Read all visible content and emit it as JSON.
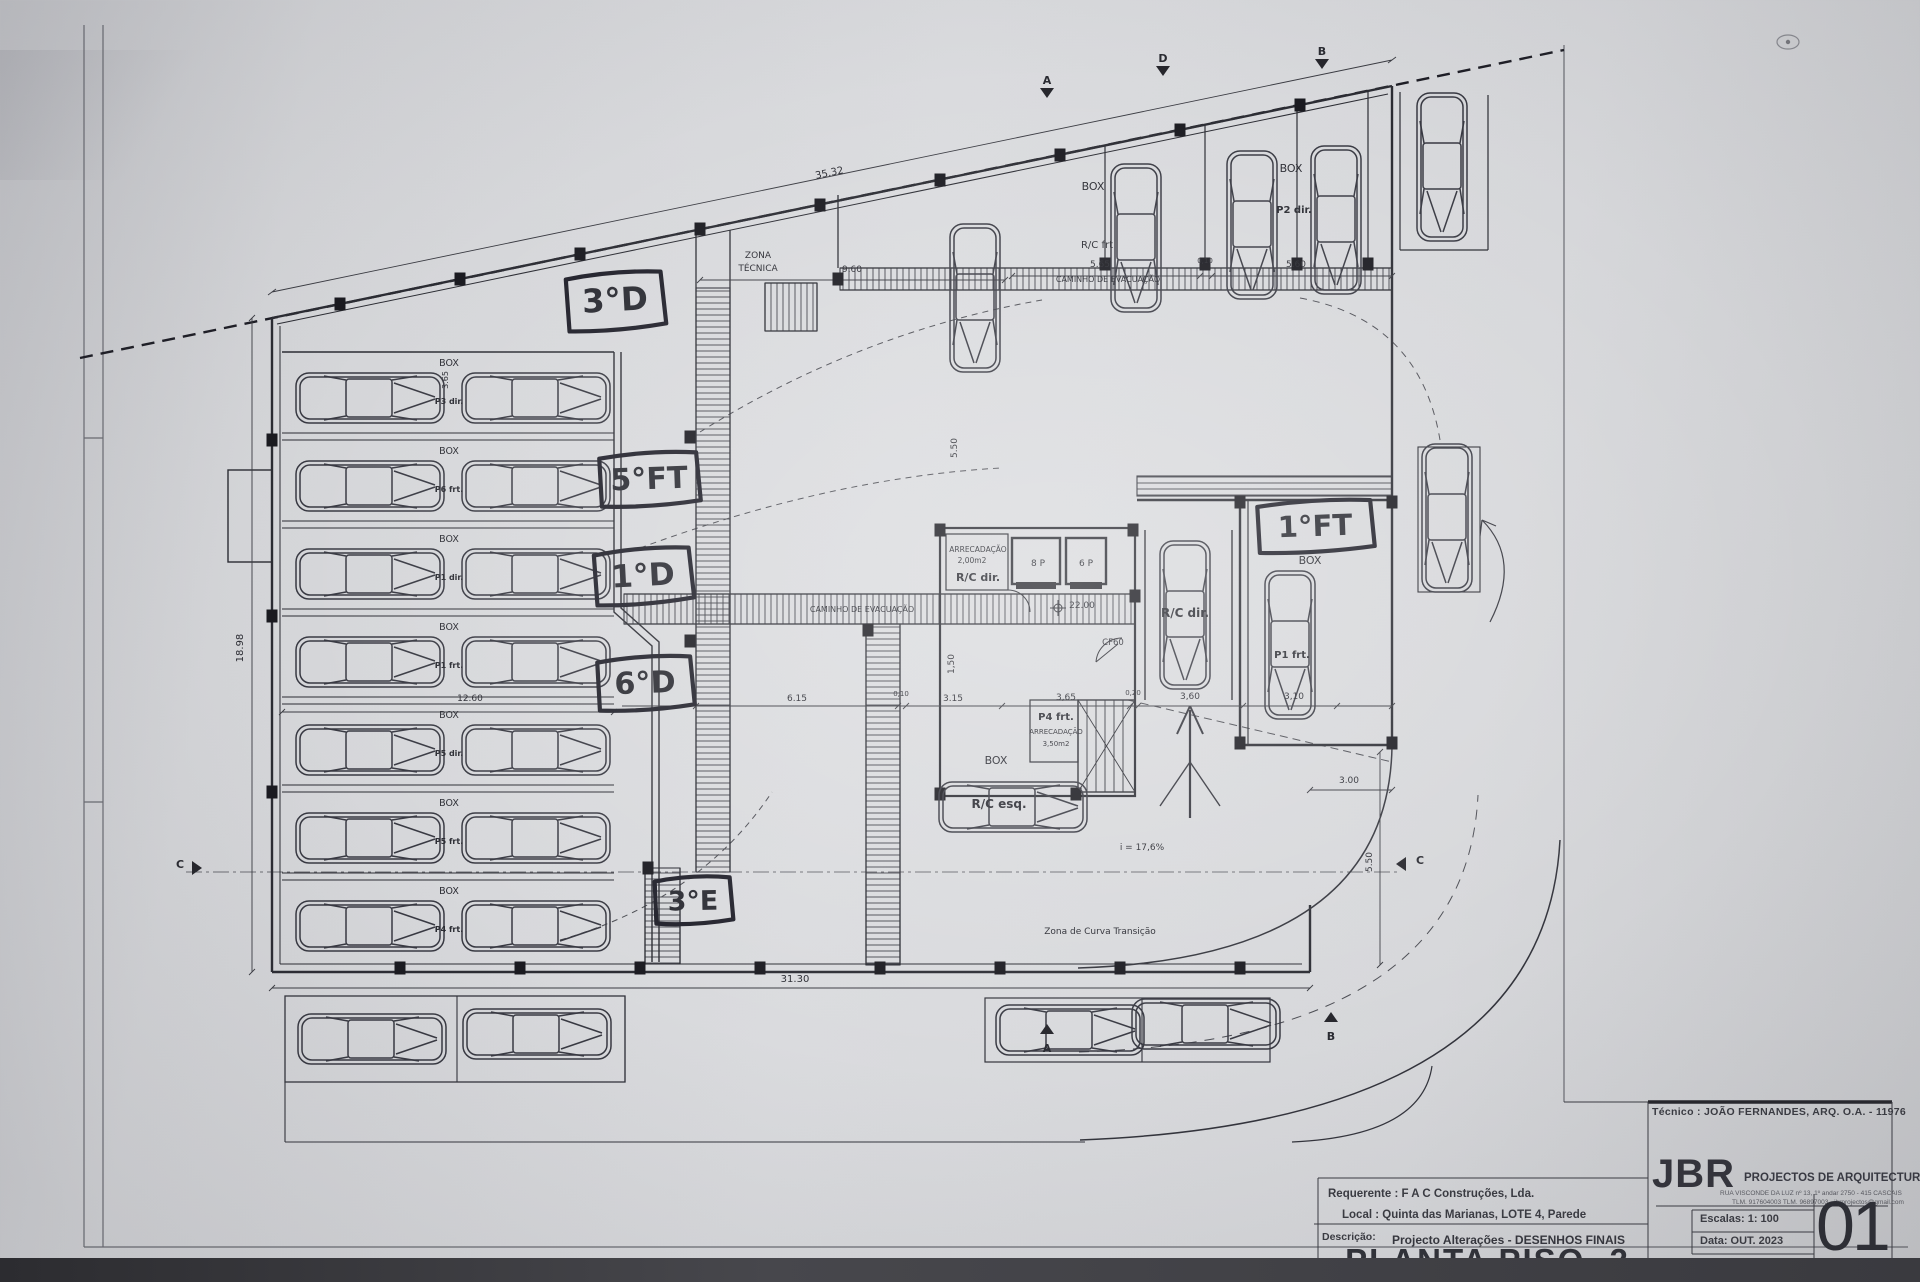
{
  "sheet": {
    "tecnico": "Técnico : JOÃO FERNANDES, ARQ.   O.A. - 11976",
    "firm": {
      "logo": "JBR",
      "name": "PROJECTOS DE ARQUITECTURA",
      "address1": "RUA VISCONDE DA LUZ nº 13, 1º andar  2750 - 415  CASCAIS",
      "address2": "TLM. 917604003  TLM. 96897003 - jbrprojectos@gmail.com"
    },
    "requerente": "Requerente : F A C  Construções, Lda.",
    "local": "Local : Quinta das Marianas, LOTE 4, Parede",
    "descricao_label": "Descrição:",
    "descricao": "Projecto Alterações - DESENHOS FINAIS",
    "drawing_title": "PLANTA PISO -2",
    "escalas": "Escalas:  1: 100",
    "data": "Data: OUT.  2023",
    "sheet_number": "01"
  },
  "handwritten": [
    {
      "t": "3°D",
      "x": 565,
      "y": 272,
      "w": 100,
      "h": 58,
      "r": -3
    },
    {
      "t": "5°FT",
      "x": 598,
      "y": 452,
      "w": 102,
      "h": 54,
      "r": -2
    },
    {
      "t": "1°D",
      "x": 593,
      "y": 548,
      "w": 100,
      "h": 56,
      "r": -3
    },
    {
      "t": "6°D",
      "x": 596,
      "y": 656,
      "w": 98,
      "h": 54,
      "r": -2
    },
    {
      "t": "3°E",
      "x": 653,
      "y": 876,
      "w": 80,
      "h": 48,
      "r": -1
    },
    {
      "t": "1°FT",
      "x": 1256,
      "y": 500,
      "w": 118,
      "h": 52,
      "r": -2
    }
  ],
  "labels": [
    {
      "t": "ZONA",
      "x": 758,
      "y": 258,
      "s": 9
    },
    {
      "t": "TÉCNICA",
      "x": 758,
      "y": 271,
      "s": 9
    },
    {
      "t": "CAMINHO DE EVACUAÇÃO",
      "x": 1108,
      "y": 282,
      "s": 8
    },
    {
      "t": "CAMINHO DE EVACUAÇÃO",
      "x": 862,
      "y": 612,
      "s": 8
    },
    {
      "t": "BOX",
      "x": 1093,
      "y": 190,
      "s": 11
    },
    {
      "t": "R/C frt",
      "x": 1097,
      "y": 248,
      "s": 10
    },
    {
      "t": "BOX",
      "x": 1291,
      "y": 172,
      "s": 11
    },
    {
      "t": "P2 dir.",
      "x": 1294,
      "y": 213,
      "s": 10,
      "b": 1
    },
    {
      "t": "BOX",
      "x": 1310,
      "y": 564,
      "s": 11
    },
    {
      "t": "P1 frt.",
      "x": 1292,
      "y": 658,
      "s": 10,
      "b": 1
    },
    {
      "t": "R/C dir.",
      "x": 1185,
      "y": 617,
      "s": 12,
      "b": 1
    },
    {
      "t": "ARRECADAÇÃO",
      "x": 978,
      "y": 552,
      "s": 7.5
    },
    {
      "t": "2,00m2",
      "x": 972,
      "y": 563,
      "s": 7.5
    },
    {
      "t": "R/C dir.",
      "x": 978,
      "y": 581,
      "s": 11,
      "b": 1
    },
    {
      "t": "8 P",
      "x": 1038,
      "y": 566,
      "s": 9
    },
    {
      "t": "6 P",
      "x": 1086,
      "y": 566,
      "s": 9
    },
    {
      "t": "22.00",
      "x": 1082,
      "y": 608,
      "s": 9
    },
    {
      "t": "CF60",
      "x": 1113,
      "y": 645,
      "s": 8.5
    },
    {
      "t": "P4 frt.",
      "x": 1056,
      "y": 720,
      "s": 10,
      "b": 1
    },
    {
      "t": "ARRECADAÇÃO",
      "x": 1056,
      "y": 734,
      "s": 7
    },
    {
      "t": "3,50m2",
      "x": 1056,
      "y": 746,
      "s": 7
    },
    {
      "t": "BOX",
      "x": 996,
      "y": 764,
      "s": 11
    },
    {
      "t": "R/C esq.",
      "x": 999,
      "y": 808,
      "s": 12,
      "b": 1
    },
    {
      "t": "i = 17,6%",
      "x": 1142,
      "y": 850,
      "s": 9
    },
    {
      "t": "Zona de Curva Transição",
      "x": 1100,
      "y": 934,
      "s": 9
    },
    {
      "t": "BOX",
      "x": 449,
      "y": 366,
      "s": 9.5
    },
    {
      "t": "P3 dir.",
      "x": 449,
      "y": 404,
      "s": 8,
      "b": 1
    },
    {
      "t": "BOX",
      "x": 449,
      "y": 454,
      "s": 9.5
    },
    {
      "t": "P6 frt.",
      "x": 449,
      "y": 492,
      "s": 8,
      "b": 1
    },
    {
      "t": "BOX",
      "x": 449,
      "y": 542,
      "s": 9.5
    },
    {
      "t": "P1 dir.",
      "x": 449,
      "y": 580,
      "s": 8,
      "b": 1
    },
    {
      "t": "BOX",
      "x": 449,
      "y": 630,
      "s": 9.5
    },
    {
      "t": "P1 frt.",
      "x": 449,
      "y": 668,
      "s": 8,
      "b": 1
    },
    {
      "t": "BOX",
      "x": 449,
      "y": 718,
      "s": 9.5
    },
    {
      "t": "P5 dir.",
      "x": 449,
      "y": 756,
      "s": 8,
      "b": 1
    },
    {
      "t": "BOX",
      "x": 449,
      "y": 806,
      "s": 9.5
    },
    {
      "t": "P5 frt.",
      "x": 449,
      "y": 844,
      "s": 8,
      "b": 1
    },
    {
      "t": "BOX",
      "x": 449,
      "y": 894,
      "s": 9.5
    },
    {
      "t": "P4 frt.",
      "x": 449,
      "y": 932,
      "s": 8,
      "b": 1
    }
  ],
  "dimensions": [
    {
      "t": "35.32",
      "x": 830,
      "y": 176,
      "s": 10,
      "r": -11.7
    },
    {
      "t": "9.60",
      "x": 852,
      "y": 272,
      "s": 9
    },
    {
      "t": "5.65",
      "x": 1100,
      "y": 267,
      "s": 9
    },
    {
      "t": "0,10",
      "x": 1205,
      "y": 263,
      "s": 7
    },
    {
      "t": "5.60",
      "x": 1296,
      "y": 267,
      "s": 9
    },
    {
      "t": "12.60",
      "x": 470,
      "y": 701,
      "s": 9
    },
    {
      "t": "6.15",
      "x": 797,
      "y": 701,
      "s": 9
    },
    {
      "t": "0,10",
      "x": 901,
      "y": 696,
      "s": 7
    },
    {
      "t": "3.15",
      "x": 953,
      "y": 701,
      "s": 9
    },
    {
      "t": "3,65",
      "x": 1066,
      "y": 700,
      "s": 9
    },
    {
      "t": "0,20",
      "x": 1133,
      "y": 695,
      "s": 7
    },
    {
      "t": "3,60",
      "x": 1190,
      "y": 699,
      "s": 9
    },
    {
      "t": "3,10",
      "x": 1294,
      "y": 699,
      "s": 9
    },
    {
      "t": "3.00",
      "x": 1349,
      "y": 783,
      "s": 9
    },
    {
      "t": "5.50",
      "x": 1372,
      "y": 862,
      "s": 9,
      "r": -90
    },
    {
      "t": "5.50",
      "x": 957,
      "y": 448,
      "s": 9,
      "r": -90
    },
    {
      "t": "1,50",
      "x": 954,
      "y": 664,
      "s": 9,
      "r": -90
    },
    {
      "t": "31.30",
      "x": 795,
      "y": 982,
      "s": 10
    },
    {
      "t": "18.98",
      "x": 243,
      "y": 648,
      "s": 10,
      "r": -90
    },
    {
      "t": "3.65",
      "x": 448,
      "y": 380,
      "s": 8,
      "r": -90
    }
  ],
  "markers": [
    {
      "t": "A",
      "x": 1047,
      "y": 84,
      "d": "down"
    },
    {
      "t": "D",
      "x": 1163,
      "y": 62,
      "d": "down"
    },
    {
      "t": "B",
      "x": 1322,
      "y": 55,
      "d": "down"
    },
    {
      "t": "C",
      "x": 186,
      "y": 868,
      "d": "right"
    },
    {
      "t": "C",
      "x": 1412,
      "y": 864,
      "d": "left"
    },
    {
      "t": "A",
      "x": 1047,
      "y": 1030,
      "d": "up"
    },
    {
      "t": "B",
      "x": 1331,
      "y": 1018,
      "d": "up"
    }
  ]
}
